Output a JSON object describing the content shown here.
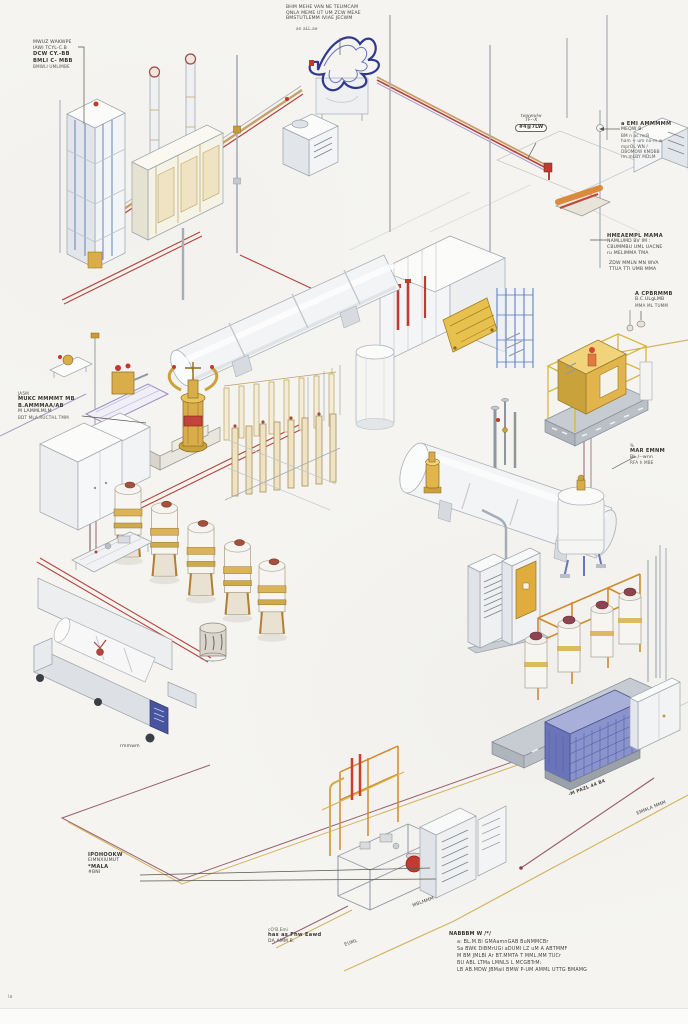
{
  "page": {
    "page_mark": "ia"
  },
  "colors": {
    "paper": "#f5f4f1",
    "pipe_red": "#b5443c",
    "pipe_maroon": "#9a6070",
    "pipe_yellow": "#d3b461",
    "pipe_purple": "#a79ac8",
    "pipe_tan": "#c8a06a",
    "gold": "#d9ae4a",
    "steel_stroke": "#9aa2ab",
    "blue_frame": "#5578c0",
    "coil_blue": "#2f3a8e",
    "panel_blue": "#47549e",
    "cream": "#efe3c4",
    "red_accent": "#c0392b",
    "cage_yellow": "#e2b44c"
  },
  "equipment": [
    "process-tower",
    "twin-columns",
    "agitator-coil-mixer",
    "rotary-kiln",
    "gold-valve-column",
    "tube-bank",
    "yellow-caged-unit",
    "horizontal-vessel",
    "fermenter-tank-row",
    "enclosed-horizontal-tank",
    "orange-frame-skid",
    "control-cabinets",
    "blue-mesh-compressor",
    "storage-silo",
    "heat-exchanger-block",
    "pipe-racks"
  ],
  "annotations": {
    "top_left": {
      "l1": "MWUZ WAKWPE",
      "l2": "IAWI TCYL-C.B",
      "l3": "DCW CY.-BB",
      "l4": "BMLI C- MBB",
      "l5": "BMWLI UMLIMBE"
    },
    "top_center": {
      "l1": "BHM MEHE VAN NE TEUMCAM",
      "l2": "QNLA MEME UT UM ZCW MEAE",
      "l3": "BMSTUTLEMM IVIAE JECWM",
      "sub": "an aLL.ae"
    },
    "balloon": {
      "top": "twwwwlw",
      "mid": "7F--X",
      "bubble": "#4@7LW"
    },
    "right_fire": {
      "l1": "a EMI AMMMMM",
      "l2": "MEQW B.",
      "l3": "BM n ac mrB",
      "l4": "ham + um nx-m-w",
      "l5": "mprOL WN /",
      "l6": "DBOMOW KMDBB",
      "l7": "rm mLBY MDLM"
    },
    "right_mid": {
      "l1": "HMEAEMPL MAMA",
      "l2": "NAMLUMD BV IM :",
      "l3": "CBUMMBU UML UACNE",
      "l4": "ru MELIMMA TMA"
    },
    "right_lower": {
      "l1": "ZDW MMLN MN WVA",
      "l2": "TTUA TTI UMB MMA"
    },
    "right_cpb": {
      "l1": "A CPBRMMB",
      "l2": "B.C.ULgLMB",
      "l3": "MMA ML TUMM"
    },
    "star": {
      "l1": "%",
      "l2": "MAR EMNM",
      "l3": "BL./--wnn",
      "l4": "RFA h MBE"
    },
    "mid_left": {
      "l1": "JA5M",
      "l2": "MUKC MMMMT MB",
      "l3": "B.AMMMAA/AB",
      "l4": "M LAMMLMLM",
      "l5": "BDT MLA.RUCTHL TMM"
    },
    "bottom_left": {
      "l1": "IPOHOOKW",
      "l2": "EIMNXIUMUT",
      "l3": "*MALA",
      "l4": "#BNI"
    },
    "bottom_small": {
      "l1": "cO'B.Emi",
      "l2": "has as Fhw Eawd",
      "l3": "DA AMM B."
    },
    "notes": {
      "title": "NABBBM W /*/",
      "items": [
        "a: BL.M.Bi GMAamnGAB BuNMMCBr",
        "Sa BWK DiBMrUGi aDUMI LZ uM A ABTMMF",
        "M BM JMLBI Ar BT.MMTA T MML.MM TUCr",
        "BU ABL LTMa LMNLS L MCGBTrM:",
        "LB AB.MDW JBMail BMW P-UM AMML UTTG BMAMG"
      ]
    },
    "pipe_rot_1": "-M PAZL 44 B4",
    "pipe_rot_2": "EMMLA MMM",
    "pipe_rot_3": "MBLMMM",
    "edge_small": "EUML",
    "ferm_small": "rmmwm"
  }
}
